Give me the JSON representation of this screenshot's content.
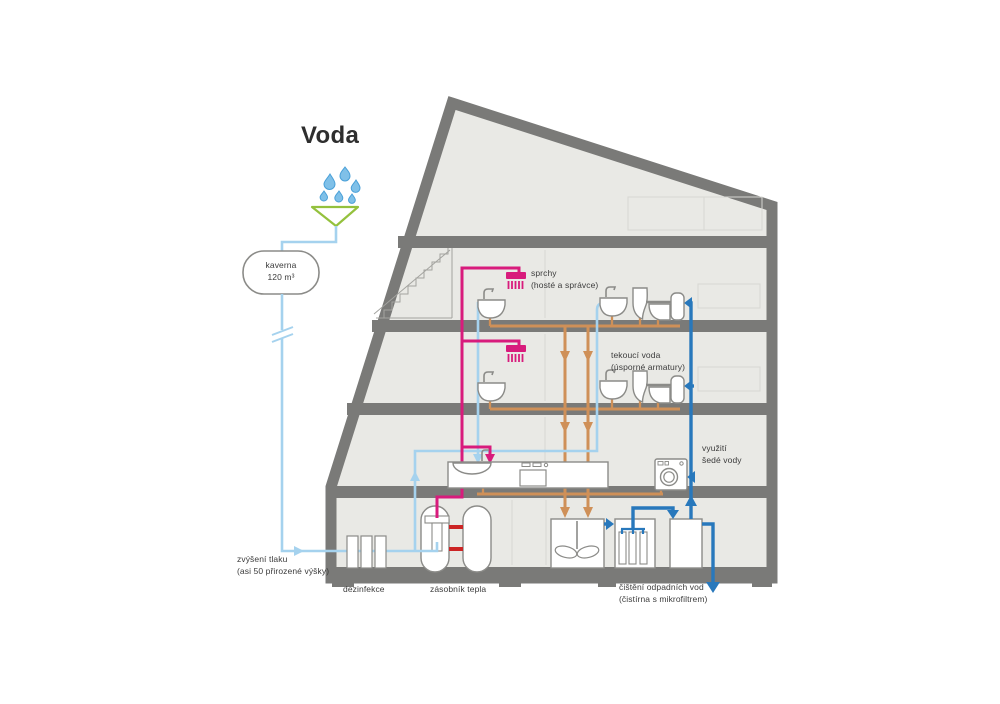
{
  "title": "Voda",
  "labels": {
    "cavern": "kaverna\n120 m³",
    "showers": "sprchy\n(hosté a správce)",
    "running_water": "tekoucí voda\n(úsporné armatury)",
    "grey_water_use": "využití\nšedé vody",
    "pressure_boost": "zvýšení tlaku\n(asi 50 přirozené výšky)",
    "disinfection": "dezinfekce",
    "heat_storage": "zásobník tepla",
    "waste_treatment": "čištění odpadních vod\n(čistírna s mikrofiltrem)"
  },
  "colors": {
    "wall": "#7a7a78",
    "interior": "#e9e9e5",
    "fresh": "#a5d2ee",
    "grey": "#2878bc",
    "hot": "#d81b7c",
    "waste": "#cf9058",
    "heat": "#cc2424",
    "green": "#94c13d",
    "drop": "#7fc0e8",
    "text": "#3c3c3c"
  }
}
